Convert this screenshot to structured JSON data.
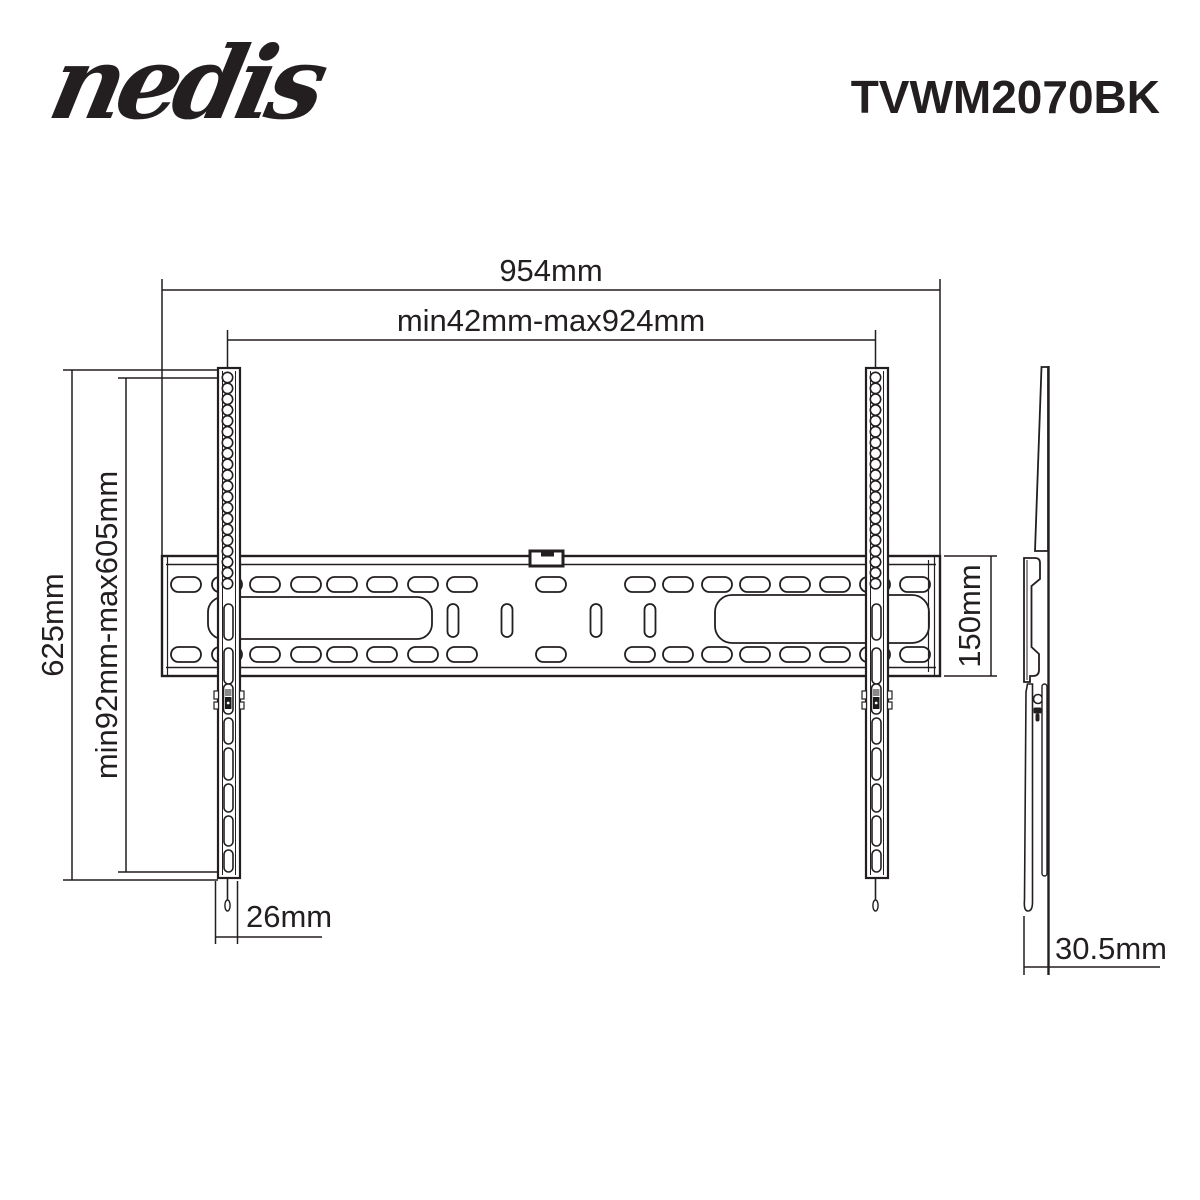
{
  "header": {
    "logo_text": "nedis",
    "product_code": "TVWM2070BK"
  },
  "front_view": {
    "dim_overall_width": "954mm",
    "dim_mount_width_range": "min42mm-max924mm",
    "dim_overall_height": "625mm",
    "dim_mount_height_range": "min92mm-max605mm",
    "dim_wall_plate_height": "150mm",
    "dim_rail_width": "26mm"
  },
  "side_view": {
    "dim_depth": "30.5mm"
  },
  "colors": {
    "line_color": "#231f20",
    "background": "#ffffff"
  }
}
